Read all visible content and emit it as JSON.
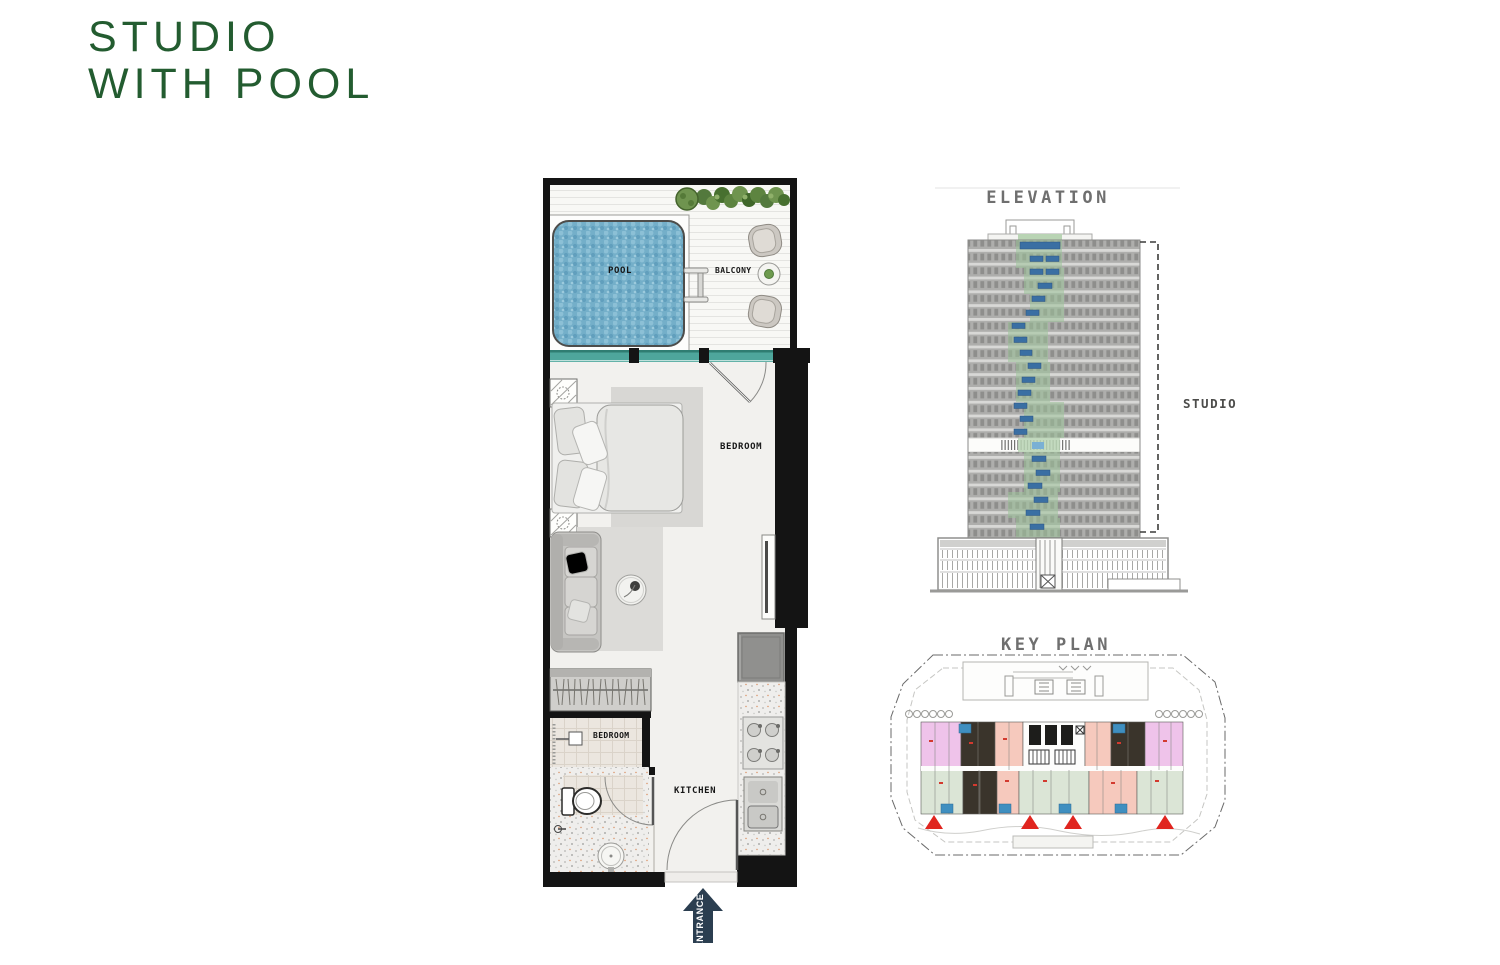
{
  "page": {
    "title": {
      "line1": "STUDIO",
      "line2": "WITH POOL",
      "color": "#235c30"
    },
    "background": "#ffffff"
  },
  "floor_plan": {
    "rooms": {
      "pool": "POOL",
      "balcony": "BALCONY",
      "bedroom": "BEDROOM",
      "bathroom": "BEDROOM",
      "kitchen": "KITCHEN"
    },
    "entrance_label": "ENTRANCE",
    "colors": {
      "wall": "#141414",
      "floor": "#f2f1ee",
      "pool_water": "#74afc9",
      "window_band": "#4ea69c",
      "deck": "#f8f8f5",
      "entrance_arrow": "#2b3e50",
      "greenery": "#6d9a4e",
      "appliance_gray": "#90908e"
    }
  },
  "elevation": {
    "title": "ELEVATION",
    "annotation": "STUDIO",
    "colors": {
      "facade_gray": "#ababab",
      "window_stripe": "#8e8e8c",
      "highlight_green": "#9dc49a",
      "highlight_blue": "#3a6fa3"
    }
  },
  "key_plan": {
    "title": "KEY PLAN",
    "colors": {
      "unit_pink": "#efc3ea",
      "unit_salmon": "#f6c9bd",
      "unit_green": "#dbe5d6",
      "unit_highlight_dark": "#3a342b",
      "balcony_blue": "#3f8fc0",
      "marker_red": "#e0251f"
    }
  }
}
